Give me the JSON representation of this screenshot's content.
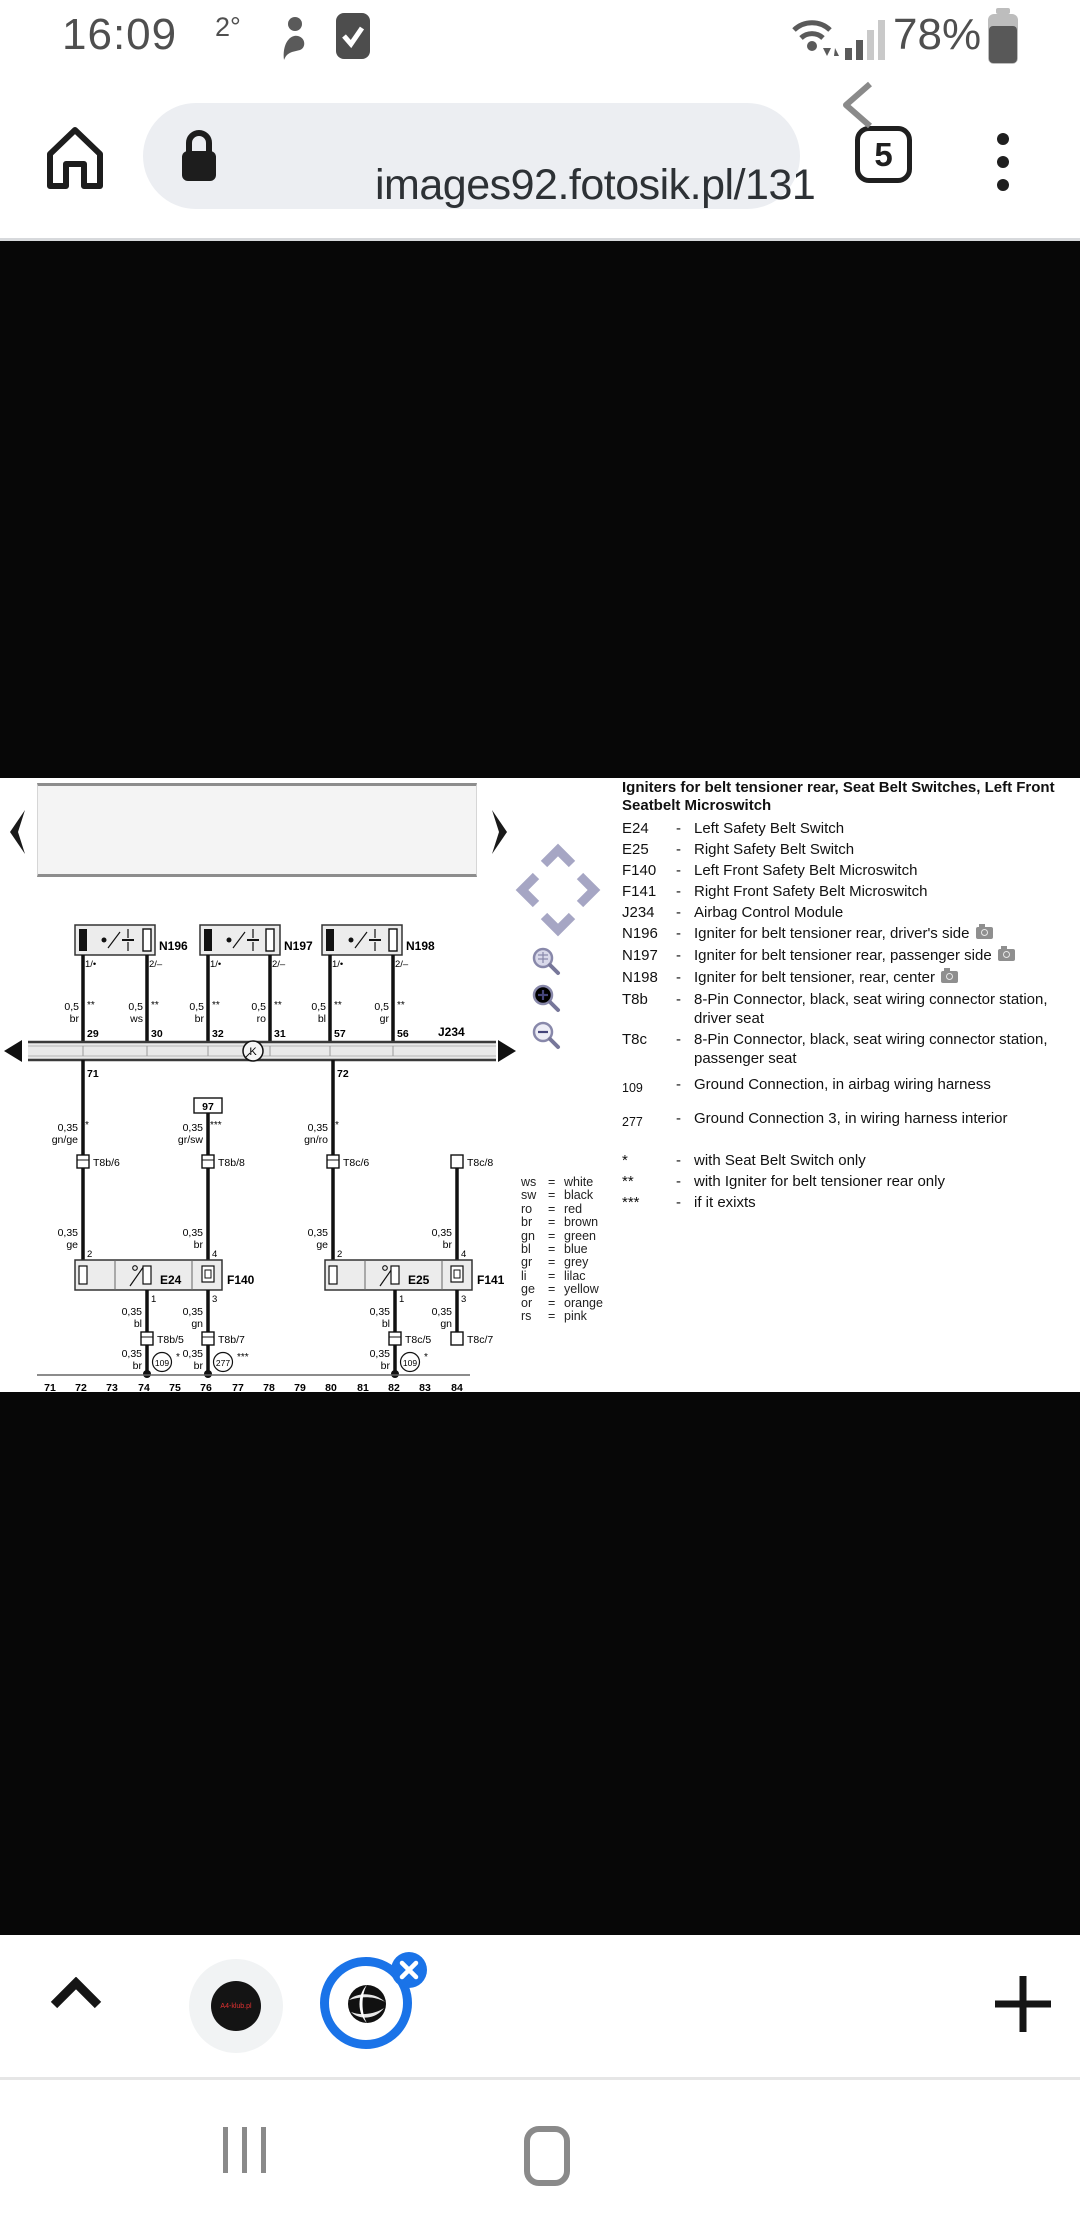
{
  "status_bar": {
    "time": "16:09",
    "temperature": "2°",
    "battery_percent": "78%"
  },
  "browser": {
    "url": "images92.fotosik.pl/131",
    "tab_count": "5"
  },
  "legend": {
    "title": "Igniters for belt tensioner rear, Seat Belt Switches, Left Front Seatbelt Microswitch",
    "separator": "-",
    "items": [
      {
        "code": "E24",
        "desc": "Left Safety Belt Switch"
      },
      {
        "code": "E25",
        "desc": "Right Safety Belt Switch"
      },
      {
        "code": "F140",
        "desc": "Left Front Safety Belt Microswitch"
      },
      {
        "code": "F141",
        "desc": "Right Front Safety Belt Microswitch"
      },
      {
        "code": "J234",
        "desc": "Airbag Control Module"
      },
      {
        "code": "N196",
        "desc": "Igniter for belt tensioner rear, driver's side"
      },
      {
        "code": "N197",
        "desc": "Igniter for belt tensioner rear, passenger side"
      },
      {
        "code": "N198",
        "desc": "Igniter for belt tensioner, rear, center"
      },
      {
        "code": "T8b",
        "desc": "8-Pin Connector, black, seat wiring connector station, driver seat"
      },
      {
        "code": "T8c",
        "desc": "8-Pin Connector, black, seat wiring connector station, passenger seat"
      },
      {
        "code": "109",
        "desc": "Ground Connection, in airbag wiring harness"
      },
      {
        "code": "277",
        "desc": "Ground Connection 3, in wiring harness interior"
      },
      {
        "code": "*",
        "desc": "with Seat Belt Switch only"
      },
      {
        "code": "**",
        "desc": "with Igniter for belt tensioner rear only"
      },
      {
        "code": "***",
        "desc": "if it exixts"
      }
    ]
  },
  "wire_colors": {
    "separator": "=",
    "rows": [
      {
        "code": "ws",
        "name": "white"
      },
      {
        "code": "sw",
        "name": "black"
      },
      {
        "code": "ro",
        "name": "red"
      },
      {
        "code": "br",
        "name": "brown"
      },
      {
        "code": "gn",
        "name": "green"
      },
      {
        "code": "bl",
        "name": "blue"
      },
      {
        "code": "gr",
        "name": "grey"
      },
      {
        "code": "li",
        "name": "lilac"
      },
      {
        "code": "ge",
        "name": "yellow"
      },
      {
        "code": "or",
        "name": "orange"
      },
      {
        "code": "rs",
        "name": "pink"
      }
    ]
  },
  "sch": {
    "i0": {
      "name": "N196",
      "pa": "1/•",
      "pb": "2/–",
      "wa_s": "0,5",
      "wa_n": "**",
      "wa_c": "br",
      "wa_p": "29",
      "wb_s": "0,5",
      "wb_n": "**",
      "wb_c": "ws",
      "wb_p": "30"
    },
    "i1": {
      "name": "N197",
      "pa": "1/•",
      "pb": "2/–",
      "wa_s": "0,5",
      "wa_n": "**",
      "wa_c": "br",
      "wa_p": "32",
      "wb_s": "0,5",
      "wb_n": "**",
      "wb_c": "ro",
      "wb_p": "31"
    },
    "i2": {
      "name": "N198",
      "pa": "1/•",
      "pb": "2/–",
      "wa_s": "0,5",
      "wa_n": "**",
      "wa_c": "bl",
      "wa_p": "57",
      "wb_s": "0,5",
      "wb_n": "**",
      "wb_c": "gr",
      "wb_p": "56"
    },
    "bus": {
      "label": "J234",
      "k": "K",
      "p71": "71",
      "p72": "72"
    },
    "m0": {
      "s": "0,35",
      "n": "*",
      "c": "gn/ge",
      "conn": "T8b/6"
    },
    "m1": {
      "box": "97",
      "s": "0,35",
      "n": "***",
      "c": "gr/sw",
      "conn": "T8b/8"
    },
    "m2": {
      "s": "0,35",
      "n": "*",
      "c": "gn/ro",
      "conn": "T8c/6"
    },
    "m3": {
      "conn": "T8c/8"
    },
    "u0": {
      "e": "E24",
      "f": "F140",
      "t2s": "0,35",
      "t2c": "ge",
      "t2p": "2",
      "t4s": "0,35",
      "t4c": "br",
      "t4p": "4",
      "b1p": "1",
      "b1s": "0,35",
      "b1c": "bl",
      "b1conn": "T8b/5",
      "g1s": "0,35",
      "g1c": "br",
      "g1n": "*",
      "g1": "109",
      "b3p": "3",
      "b3s": "0,35",
      "b3c": "gn",
      "b3conn": "T8b/7",
      "g3s": "0,35",
      "g3c": "br",
      "g3n": "***",
      "g3": "277"
    },
    "u1": {
      "e": "E25",
      "f": "F141",
      "t2s": "0,35",
      "t2c": "ge",
      "t2p": "2",
      "t4s": "0,35",
      "t4c": "br",
      "t4p": "4",
      "b1p": "1",
      "b1s": "0,35",
      "b1c": "bl",
      "b1conn": "T8c/5",
      "g1s": "0,35",
      "g1c": "br",
      "g1n": "*",
      "g1": "109",
      "b3p": "3",
      "b3s": "0,35",
      "b3c": "gn",
      "b3conn": "T8c/7"
    },
    "tracks": [
      "71",
      "72",
      "73",
      "74",
      "75",
      "76",
      "77",
      "78",
      "79",
      "80",
      "81",
      "82",
      "83",
      "84"
    ]
  },
  "toolbar": {
    "favicon_text": "A4-klub.pl"
  }
}
